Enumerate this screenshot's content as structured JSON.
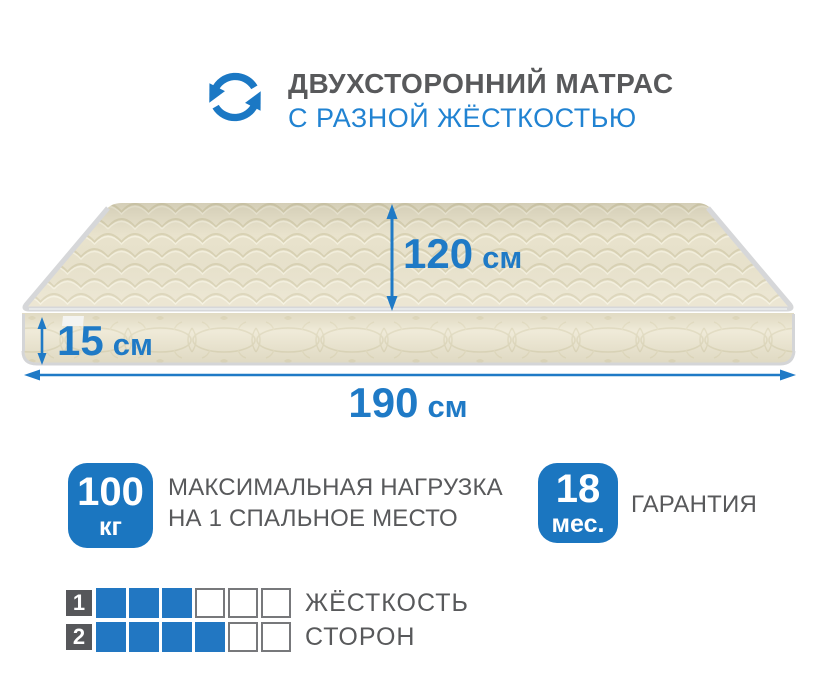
{
  "header": {
    "icon": "two-arrows-cycle",
    "title": "ДВУХСТОРОННИЙ МАТРАС",
    "subtitle": "С РАЗНОЙ ЖЁСТКОСТЬЮ"
  },
  "dimensions": {
    "depth": {
      "value": "120",
      "unit": "см"
    },
    "thickness": {
      "value": "15",
      "unit": "см"
    },
    "length": {
      "value": "190",
      "unit": "см"
    }
  },
  "badges": {
    "max_load": {
      "value": "100",
      "unit": "кг",
      "label_line1": "МАКСИМАЛЬНАЯ НАГРУЗКА",
      "label_line2": "НА 1 СПАЛЬНОЕ МЕСТО"
    },
    "warranty": {
      "value": "18",
      "unit": "мес.",
      "label": "ГАРАНТИЯ"
    }
  },
  "firmness": {
    "rows": [
      {
        "number": "1",
        "filled": 3,
        "total": 6,
        "label": "ЖЁСТКОСТЬ"
      },
      {
        "number": "2",
        "filled": 4,
        "total": 6,
        "label": "СТОРОН"
      }
    ]
  },
  "colors": {
    "accent_blue": "#1b76c0",
    "subtitle_blue": "#2183d2",
    "arrow_blue": "#1f7ac6",
    "text_gray": "#58595b",
    "square_dark": "#56575a",
    "mattress_top": "#e9e3cd",
    "mattress_side": "#ece6d0",
    "piping_gray": "#d6d7d9"
  }
}
